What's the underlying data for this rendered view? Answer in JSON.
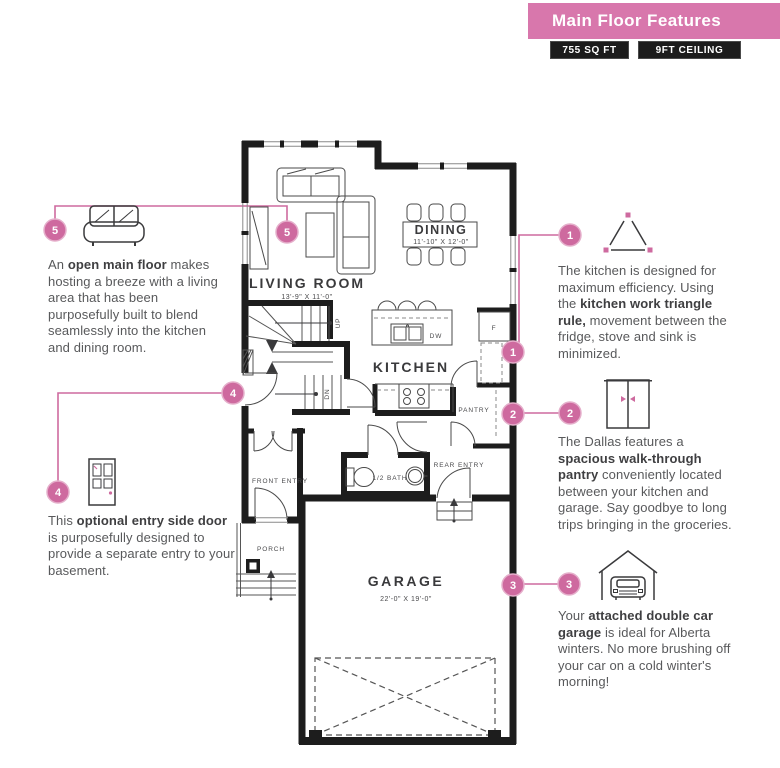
{
  "header": {
    "title": "Main Floor Features",
    "badges": [
      "755 SQ FT",
      "9FT CEILING"
    ]
  },
  "plan": {
    "rooms": {
      "living_room": {
        "name": "LIVING ROOM",
        "dims": "13'-9\" X 11'-0\""
      },
      "dining": {
        "name": "DINING",
        "dims": "11'-10\" X 12'-0\""
      },
      "kitchen": {
        "name": "KITCHEN"
      },
      "pantry": {
        "name": "PANTRY"
      },
      "front_entry": {
        "name": "FRONT ENTRY"
      },
      "half_bath": {
        "name": "1/2 BATH"
      },
      "rear_entry": {
        "name": "REAR ENTRY"
      },
      "porch": {
        "name": "PORCH"
      },
      "garage": {
        "name": "GARAGE",
        "dims": "22'-0\" X 19'-0\""
      }
    },
    "annotations": {
      "up": "UP",
      "down": "DN",
      "fridge": "F",
      "dishwasher": "DW"
    }
  },
  "callouts": [
    {
      "num": "1",
      "icon": "work-triangle-icon",
      "segments": [
        {
          "t": "The kitchen is designed for maximum efficiency. Using the "
        },
        {
          "t": "kitchen work triangle rule,",
          "b": true
        },
        {
          "t": " movement between the fridge, stove and sink is minimized."
        }
      ]
    },
    {
      "num": "2",
      "icon": "pantry-doors-icon",
      "segments": [
        {
          "t": "The Dallas features a "
        },
        {
          "t": "spacious walk-through pantry",
          "b": true
        },
        {
          "t": " conveniently located between your kitchen and garage. Say goodbye to long trips bringing in the groceries."
        }
      ]
    },
    {
      "num": "3",
      "icon": "garage-car-icon",
      "segments": [
        {
          "t": "Your "
        },
        {
          "t": "attached double car garage",
          "b": true
        },
        {
          "t": " is ideal for Alberta winters. No more brushing off your car on a cold winter's morning!"
        }
      ]
    },
    {
      "num": "4",
      "icon": "door-icon",
      "segments": [
        {
          "t": "This "
        },
        {
          "t": "optional entry side door",
          "b": true
        },
        {
          "t": " is purposefully designed to provide a separate entry to your basement."
        }
      ]
    },
    {
      "num": "5",
      "icon": "sofa-icon",
      "segments": [
        {
          "t": "An "
        },
        {
          "t": "open main floor",
          "b": true
        },
        {
          "t": " makes hosting a breeze with a living area that has been purposefully built to blend seamlessly into the kitchen and dining room."
        }
      ]
    }
  ],
  "colors": {
    "banner_pink": "#d877ac",
    "accent_pink": "#ce6a9f",
    "badge_bg": "#1c1c1c",
    "wall_black": "#1d1d1d",
    "body_text": "#58595b"
  }
}
